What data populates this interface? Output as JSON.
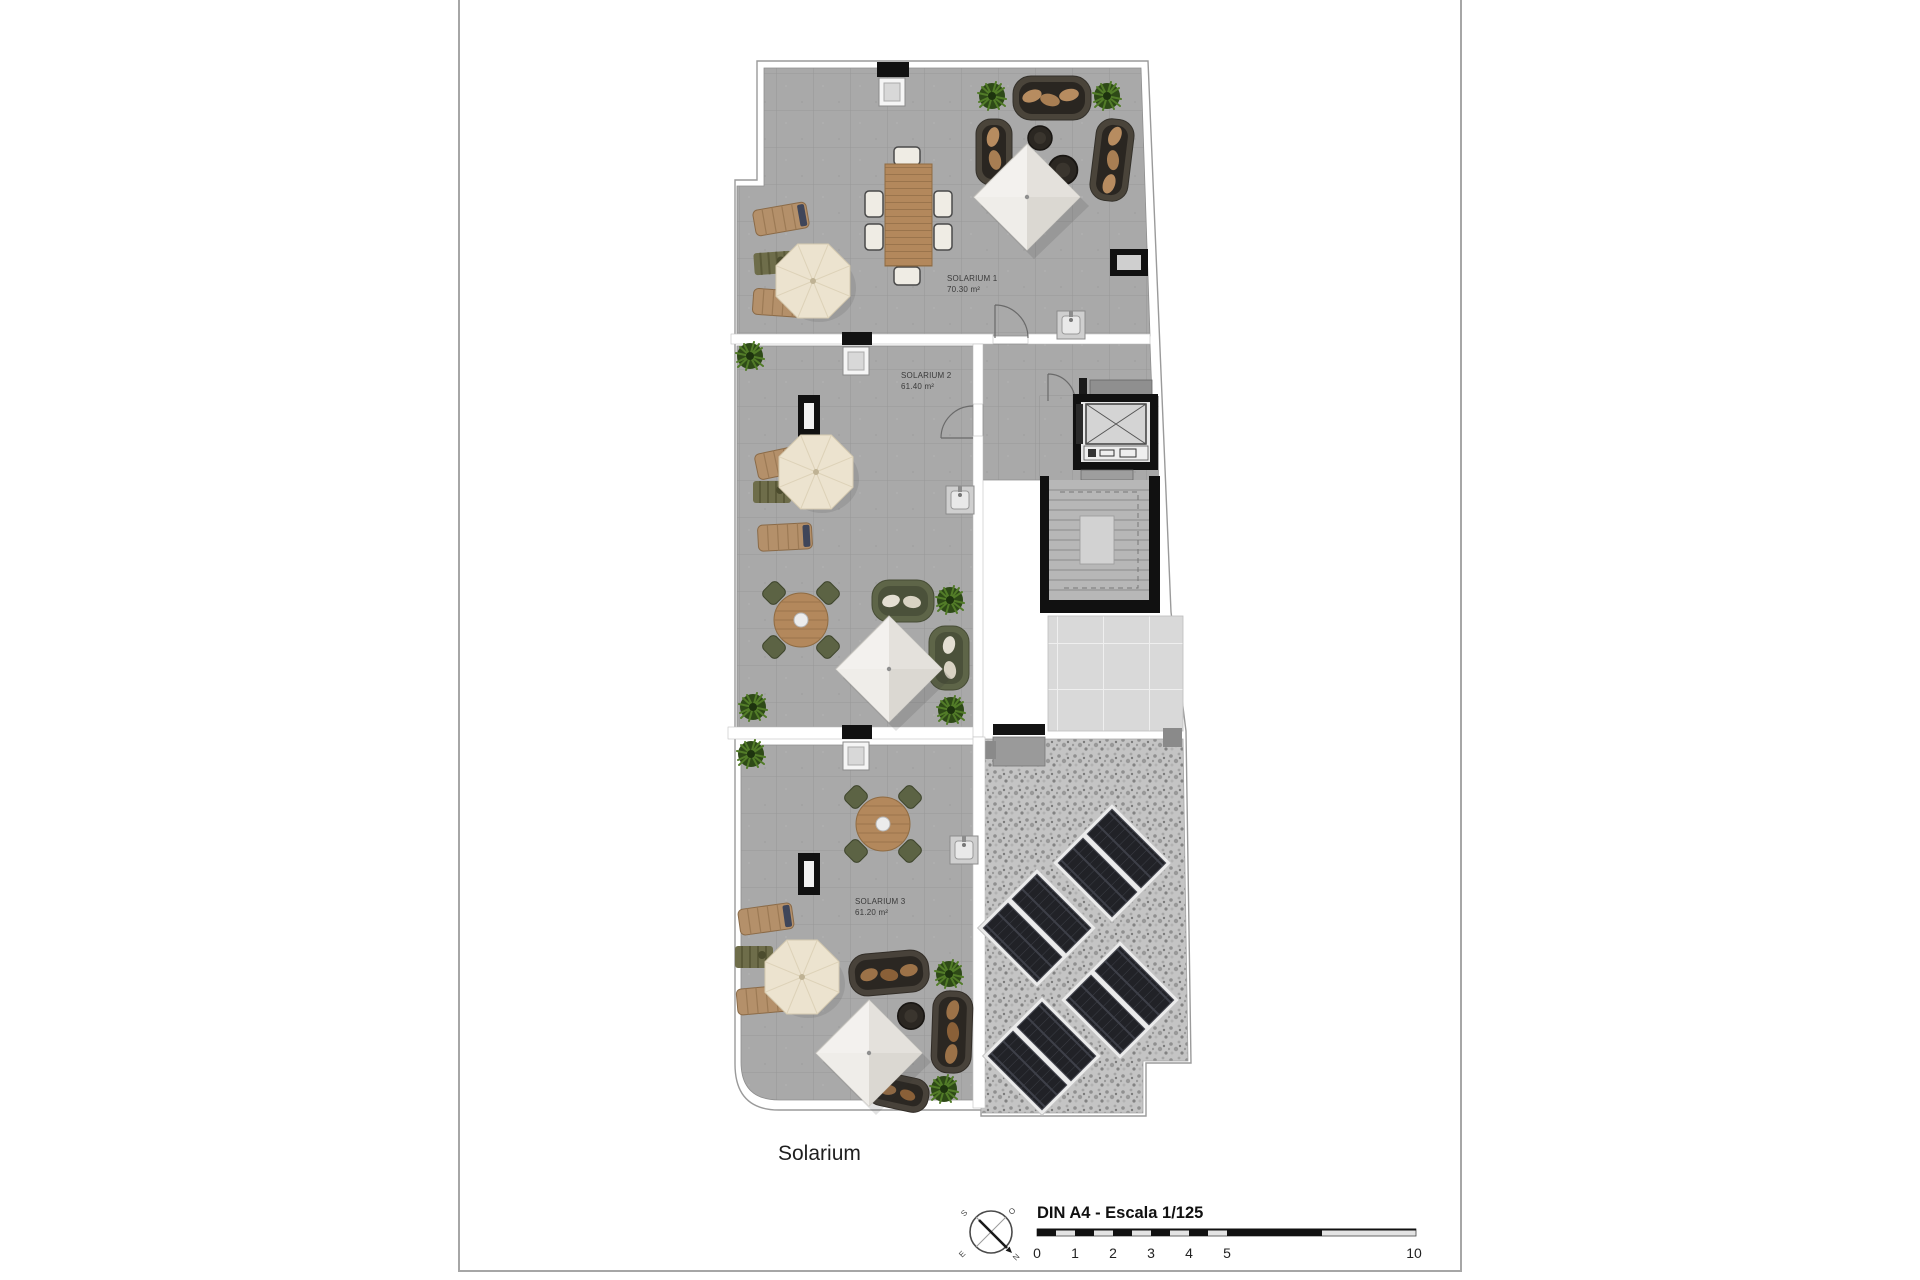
{
  "page": {
    "plan_title": "Solarium"
  },
  "rooms": [
    {
      "name": "SOLARIUM 1",
      "area": "70.30 m²"
    },
    {
      "name": "SOLARIUM 2",
      "area": "61.40 m²"
    },
    {
      "name": "SOLARIUM 3",
      "area": "61.20 m²"
    }
  ],
  "footer": {
    "scale_label": "DIN A4 - Escala 1/125",
    "ticks": [
      "0",
      "1",
      "2",
      "3",
      "4",
      "5",
      "10"
    ],
    "compass": {
      "n": "N",
      "s": "S",
      "e": "E",
      "o": "O"
    }
  },
  "colors": {
    "paper": "#ffffff",
    "page_border": "#a6a6a6",
    "tile": "#a9a9a9",
    "grout": "#999999",
    "big_tile": "#d9d9d9",
    "gravel": "#c7c7c7",
    "wall_black": "#111111",
    "solar_panel": "#212227",
    "wood": "#b3885c",
    "parasol_canvas": "#ece3cf",
    "pyramid_canvas": "#f3f1ee",
    "sofa_dark": "#4a443a",
    "sofa_green": "#5e6548",
    "cushion_tan": "#b78c60",
    "plant_green": "#2e4a17",
    "label_text": "#3a3a3a"
  }
}
